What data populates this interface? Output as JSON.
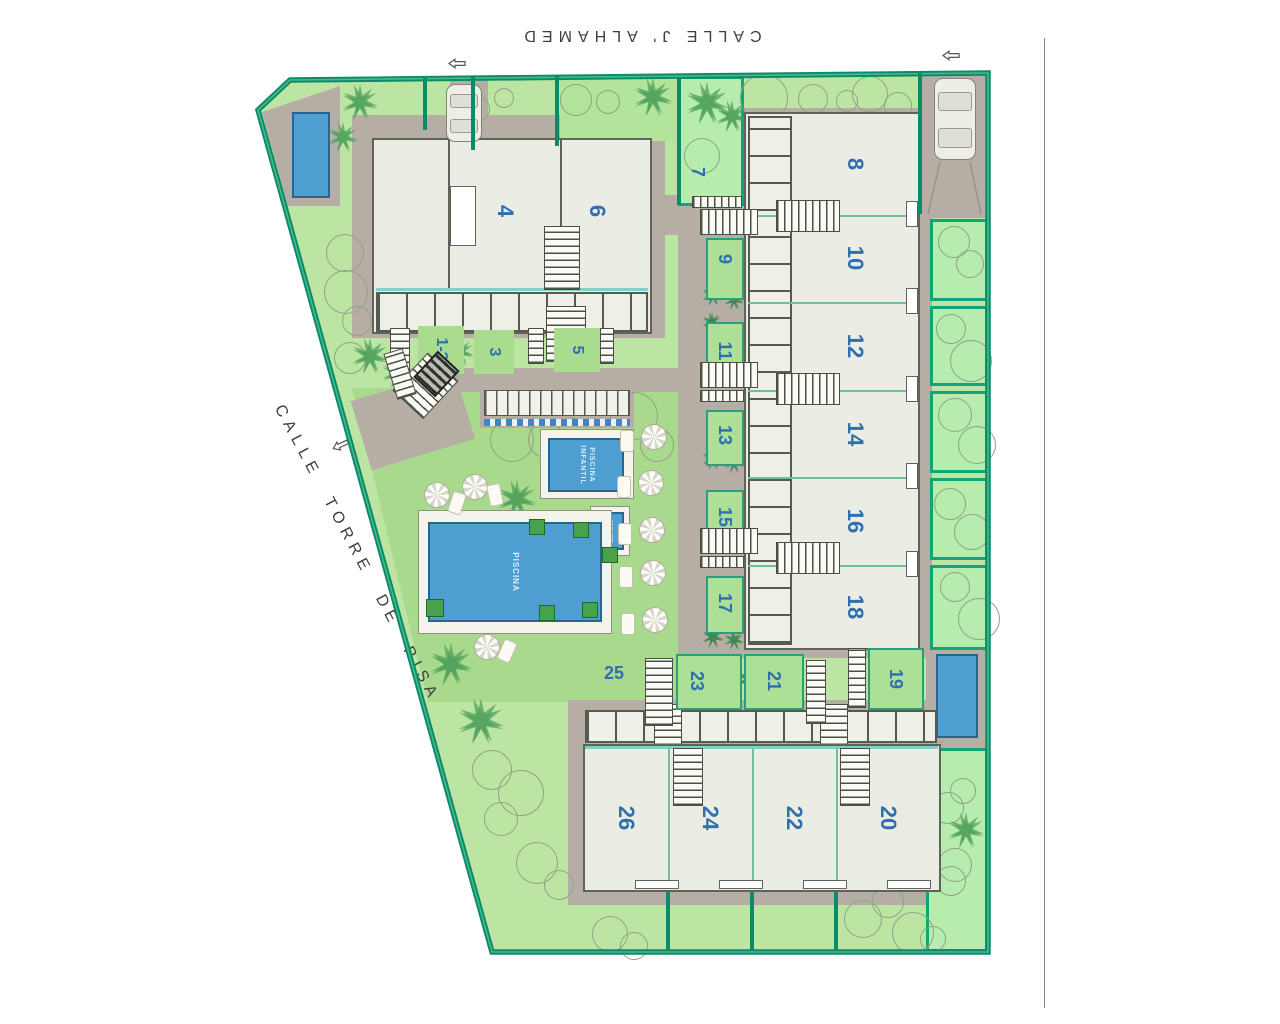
{
  "streets": {
    "top": "CALLE  J' ALHAMED",
    "left": "CALLE  TORRE  DE  PISA"
  },
  "pool": {
    "main": "PISCINA",
    "kids_line1": "PISCINA",
    "kids_line2": "INFANTIL",
    "jacuzzi": "JACUZZI"
  },
  "units": {
    "u1_2": "1-2",
    "u3": "3",
    "u4": "4",
    "u5": "5",
    "u6": "6",
    "u7": "7",
    "u8": "8",
    "u9": "9",
    "u10": "10",
    "u11": "11",
    "u12": "12",
    "u13": "13",
    "u14": "14",
    "u15": "15",
    "u16": "16",
    "u17": "17",
    "u18": "18",
    "u19": "19",
    "u20": "20",
    "u21": "21",
    "u22": "22",
    "u23": "23",
    "u24": "24",
    "u25": "25",
    "u26": "26"
  },
  "icons": {
    "tree": "outlined-circle",
    "palm": "green-star",
    "parasol": "pinwheel-circle",
    "lounger": "white-rect",
    "car": "car-top-view",
    "entrance_arrow": "hollow-left-arrow"
  },
  "colors": {
    "boundary": "#0c8c66",
    "lawn": "#bce5a4",
    "pool_lawn": "#a8d98c",
    "plot": "#b6ecae",
    "path": "#b6aea4",
    "building": "#ebede5",
    "water": "#4e9ed2",
    "unit_label": "#2f6fb0",
    "street_text": "#3f3f3f"
  }
}
